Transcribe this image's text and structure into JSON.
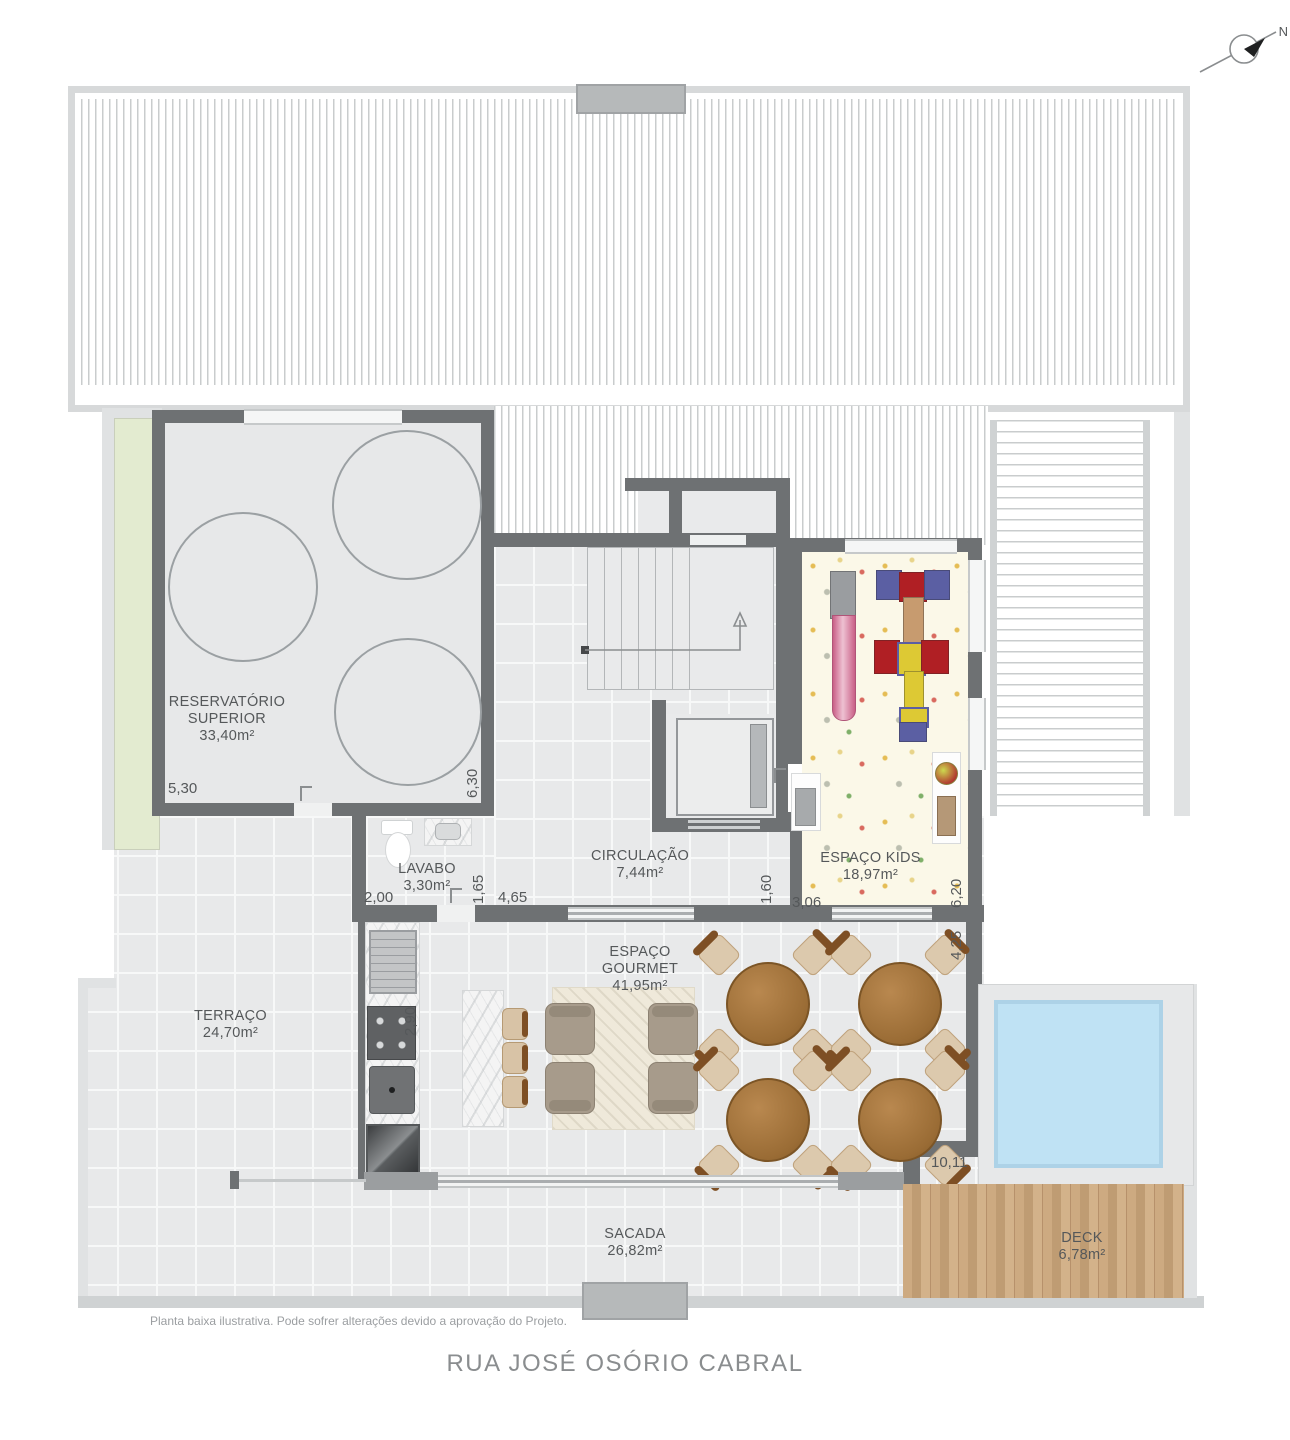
{
  "plan": {
    "north_label": "N",
    "street_name": "RUA JOSÉ OSÓRIO CABRAL",
    "disclaimer": "Planta baixa ilustrativa. Pode sofrer alterações devido a aprovação do Projeto."
  },
  "rooms": {
    "reservatorio": {
      "line1": "RESERVATÓRIO",
      "line2": "SUPERIOR",
      "area": "33,40m²"
    },
    "lavabo": {
      "name": "LAVABO",
      "area": "3,30m²"
    },
    "circulacao": {
      "name": "CIRCULAÇÃO",
      "area": "7,44m²"
    },
    "kids": {
      "name": "ESPAÇO KIDS",
      "area": "18,97m²"
    },
    "gourmet": {
      "name": "ESPAÇO GOURMET",
      "area": "41,95m²"
    },
    "terraco": {
      "name": "TERRAÇO",
      "area": "24,70m²"
    },
    "sacada": {
      "name": "SACADA",
      "area": "26,82m²"
    },
    "deck": {
      "name": "DECK",
      "area": "6,78m²"
    }
  },
  "dimensions": {
    "reservatorio_w": "5,30",
    "reservatorio_h": "6,30",
    "lavabo_w": "2,00",
    "lavabo_h": "1,65",
    "circulacao_w": "4,65",
    "circulacao_h": "1,60",
    "kids_w": "3,06",
    "kids_h": "6,20",
    "gourmet_h": "4,25",
    "kitchen_h": "2,90",
    "gourmet_w": "10,11"
  },
  "colors": {
    "wall": "#6e7173",
    "floor": "#e8e9ea",
    "green_roof": "#e3ebd0",
    "pool_water": "#bfe2f4",
    "deck_wood": "#c5a37b",
    "kids_floor": "#fbf8e8",
    "table_wood": "#9a6c35",
    "label_text": "#55585a",
    "street_text": "#8a8d8f"
  }
}
